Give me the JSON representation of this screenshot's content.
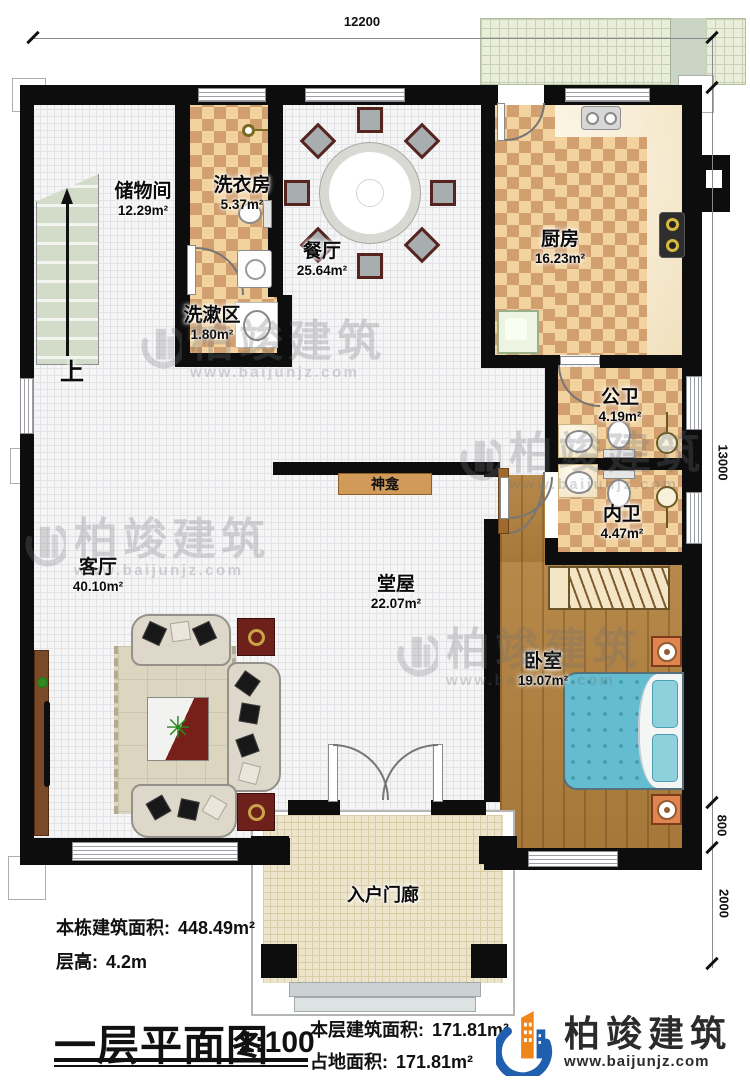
{
  "dimensions": {
    "top": "12200",
    "right_main": "13000",
    "right_lower": "800",
    "right_porch": "2000"
  },
  "rooms": {
    "storage": {
      "name": "储物间",
      "area": "12.29m²"
    },
    "laundry": {
      "name": "洗衣房",
      "area": "5.37m²"
    },
    "washing": {
      "name": "洗漱区",
      "area": "1.80m²"
    },
    "dining": {
      "name": "餐厅",
      "area": "25.64m²"
    },
    "kitchen": {
      "name": "厨房",
      "area": "16.23m²"
    },
    "public_bath": {
      "name": "公卫",
      "area": "4.19m²"
    },
    "inner_bath": {
      "name": "内卫",
      "area": "4.47m²"
    },
    "living": {
      "name": "客厅",
      "area": "40.10m²"
    },
    "hall": {
      "name": "堂屋",
      "area": "22.07m²"
    },
    "bedroom": {
      "name": "卧室",
      "area": "19.07m²"
    },
    "porch": {
      "name": "入户门廊"
    }
  },
  "annotations": {
    "shrine": "神龛",
    "stairs_up": "上"
  },
  "info": {
    "total_area_label": "本栋建筑面积:",
    "total_area_value": "448.49m²",
    "floor_height_label": "层高:",
    "floor_height_value": "4.2m"
  },
  "title_block": {
    "title": "一层平面图",
    "scale": "1:100",
    "floor_area_label": "本层建筑面积:",
    "floor_area_value": "171.81m²",
    "footprint_label": "占地面积:",
    "footprint_value": "171.81m²"
  },
  "brand": {
    "name": "柏竣建筑",
    "url": "www.baijunjz.com"
  },
  "watermark": {
    "text": "柏竣建筑",
    "url": "www.baijunjz.com"
  },
  "colors": {
    "wall": "#0d0d0d",
    "checker": "#d2a06f",
    "checker_light": "#f2d3a0",
    "wood": "#b2813e",
    "bed": "#63bccf",
    "shrine": "#d19a5b",
    "stairs": "#d3dcc9",
    "terrace": "#e9edd9",
    "porch": "#ece4cb",
    "brand_blue": "#1f5fae",
    "brand_orange": "#f08519"
  }
}
